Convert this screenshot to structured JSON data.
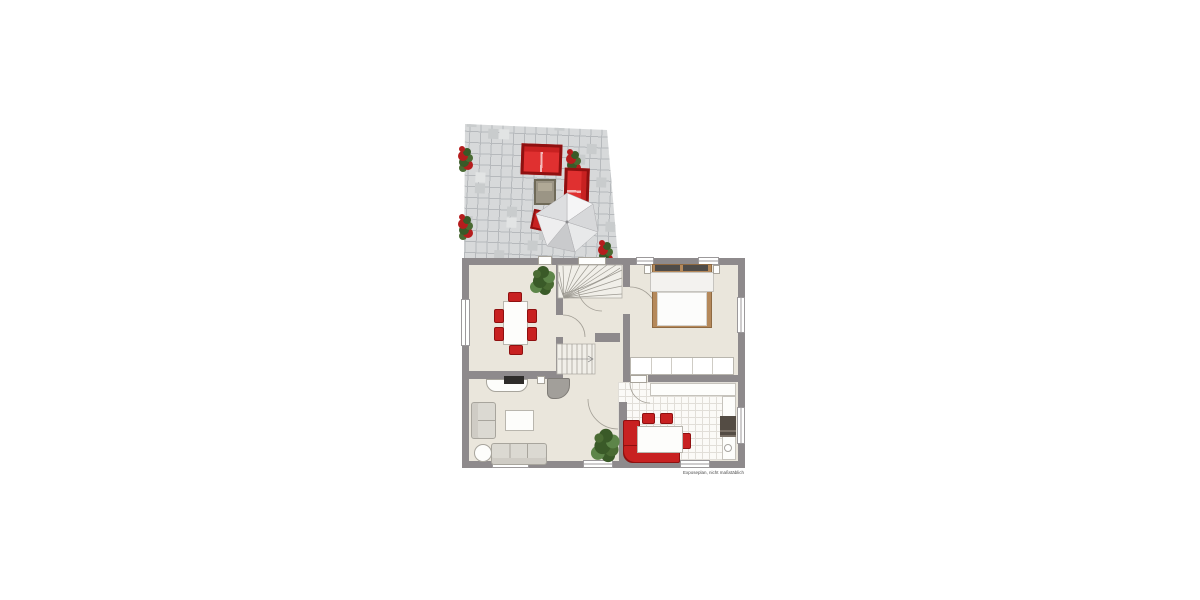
{
  "footer": {
    "disclaimer": "Exposeplan, nicht maßstäblich"
  },
  "palette": {
    "wall": "#8e8a8c",
    "floor": "#eae6dc",
    "terraceTile": "#d7d9da",
    "terraceLine": "#b6b9bc",
    "terraceDark": "#c9cccd",
    "terraceLight": "#e2e4e4",
    "kitchenTile": "#fbfaf7",
    "kitchenLine": "#e1ded8",
    "red": "#c82121",
    "redDark": "#8f1010",
    "redBright": "#e03030",
    "flowerRed": "#b51d1d",
    "plantDark": "#3a5a28",
    "plantMid": "#4a6b33",
    "plantLight": "#5d8549",
    "sofaGray": "#dbd9d2",
    "sofaEdge": "#a8a59d",
    "bedFrame": "#b5895b",
    "headboard": "#4f4c49",
    "lineLight": "#a8a49b",
    "winBorder": "#9c999b",
    "applianceDark": "#544c44",
    "objGray": "#a29f9a",
    "terrTable": "#9b9585",
    "terrTableEdge": "#6f6a58",
    "tableBorder": "#b9b6ae",
    "stairFill": "#f1efe9",
    "stairLine": "#b3b0a8",
    "textGray": "#4c4c4c"
  }
}
